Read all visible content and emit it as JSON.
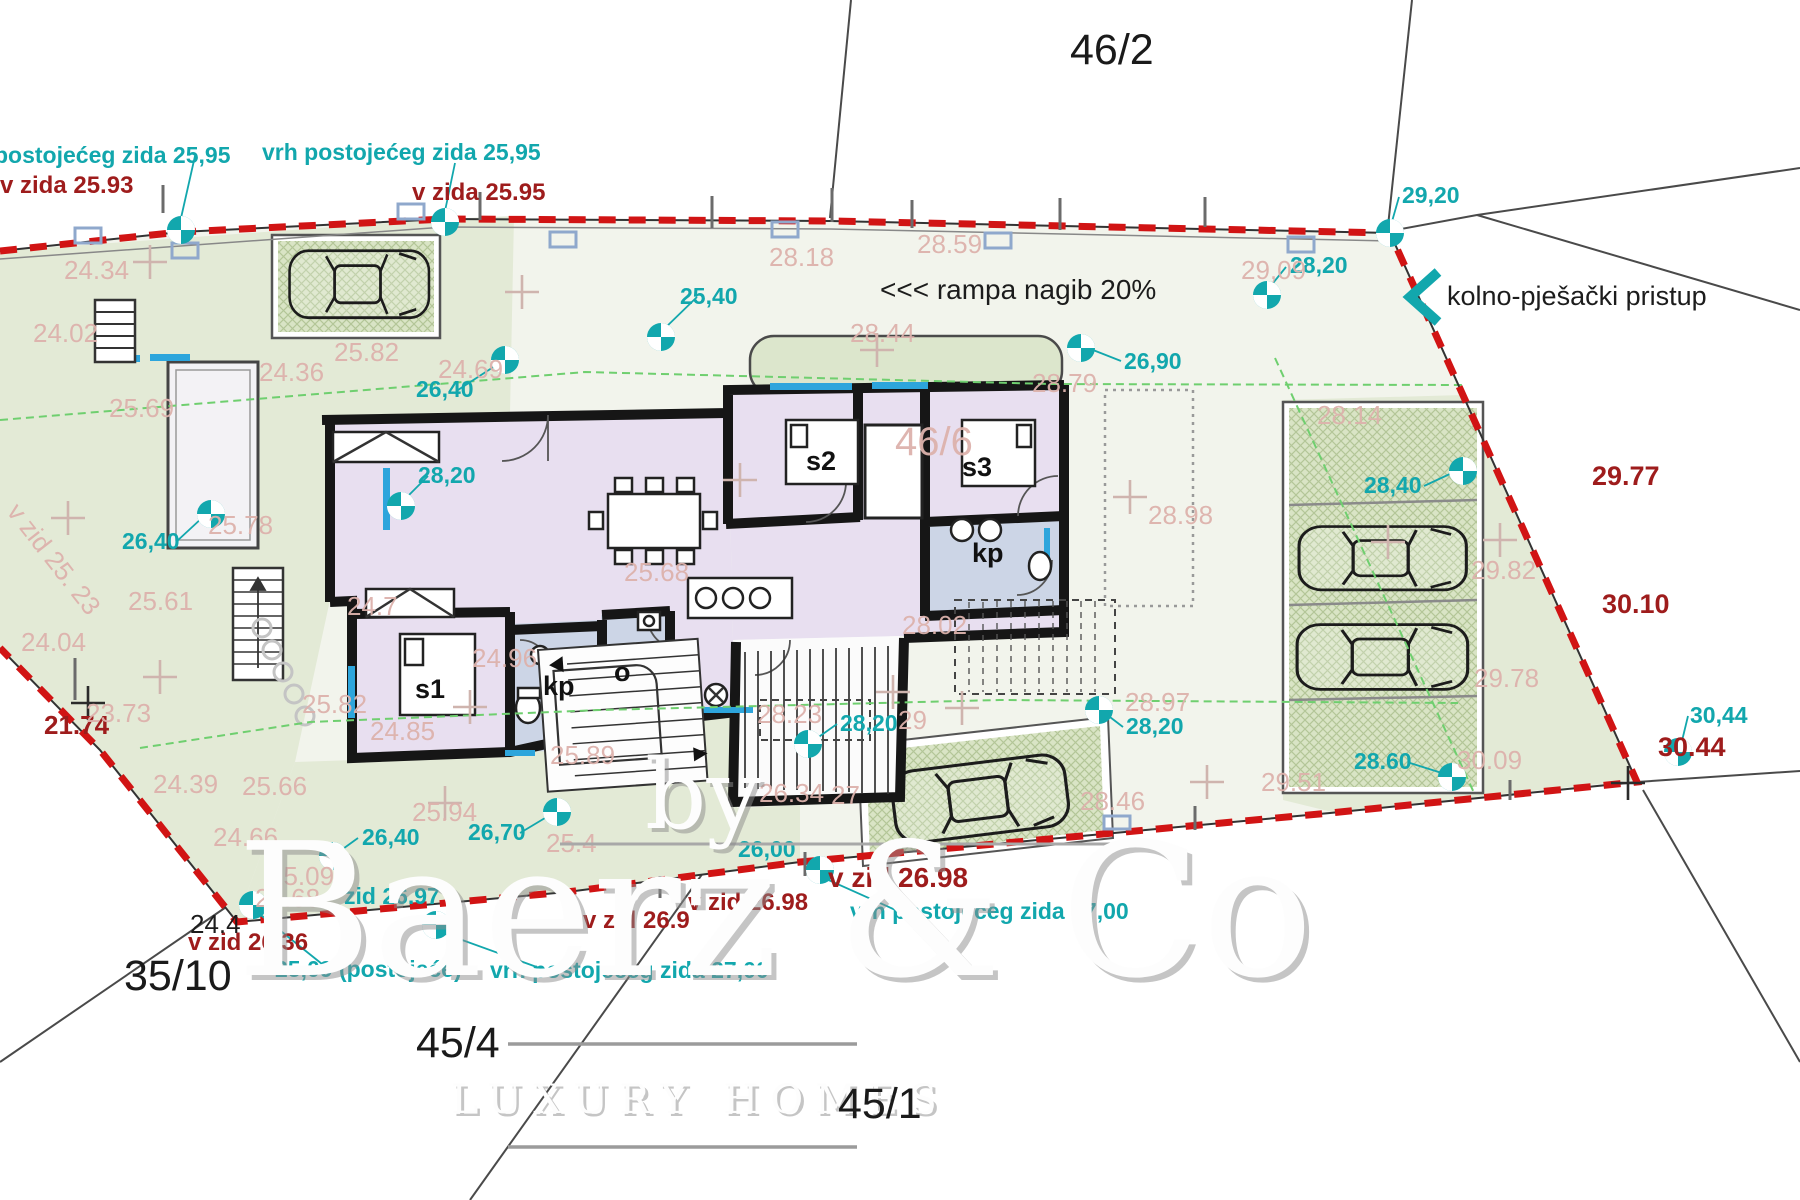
{
  "watermark": {
    "by": "by",
    "name": "Baerz & Co",
    "tagline": "LUXURY HOMES"
  },
  "annotations": {
    "ramp": "<<< rampa nagib 20%",
    "access": "kolno-pješački pristup"
  },
  "parcel_numbers": {
    "p46_2": "46/2",
    "p45_4": "45/4",
    "p35_10": "35/10",
    "p45_1": "45/1",
    "p46_6": "46/6"
  },
  "colors": {
    "survey_teal": "#12a7ad",
    "wall_red": "#9e1c1c",
    "spot_pink": "#ddb2ac",
    "boundary_red": "#d11414",
    "window_blue": "#2da5dc",
    "garden_green": "#e3ead6",
    "room_lavender": "#e8dff0",
    "bath_blue": "#ccd5e6"
  },
  "labels": {
    "teal": [
      {
        "t": "postojećeg zida 25,95",
        "x": -6,
        "y": 163
      },
      {
        "t": "vrh postojećeg zida 25,95",
        "x": 262,
        "y": 160
      },
      {
        "t": "25,40",
        "x": 680,
        "y": 304
      },
      {
        "t": "26,90",
        "x": 1124,
        "y": 369
      },
      {
        "t": "29,20",
        "x": 1402,
        "y": 203
      },
      {
        "t": "28,20",
        "x": 1290,
        "y": 273
      },
      {
        "t": "28,40",
        "x": 1364,
        "y": 493
      },
      {
        "t": "26,40",
        "x": 416,
        "y": 397
      },
      {
        "t": "28,20",
        "x": 418,
        "y": 483
      },
      {
        "t": "26,40",
        "x": 122,
        "y": 549
      },
      {
        "t": "26,40",
        "x": 362,
        "y": 845
      },
      {
        "t": "26,70",
        "x": 468,
        "y": 840
      },
      {
        "t": "zid 26.97",
        "x": 344,
        "y": 904
      },
      {
        "t": "25,09 (postojeće)",
        "x": 275,
        "y": 977
      },
      {
        "t": "vrh postojećeg zida 27,00",
        "x": 490,
        "y": 978
      },
      {
        "t": "vrh postojećeg zida 27,00",
        "x": 850,
        "y": 919
      },
      {
        "t": "26,00",
        "x": 738,
        "y": 857
      },
      {
        "t": "28,20",
        "x": 840,
        "y": 731
      },
      {
        "t": "28,20",
        "x": 1126,
        "y": 734
      },
      {
        "t": "28.60",
        "x": 1354,
        "y": 769
      },
      {
        "t": "30,44",
        "x": 1690,
        "y": 723
      }
    ],
    "red": [
      {
        "t": "v zida 25.93",
        "x": 0,
        "y": 193
      },
      {
        "t": "v zida 25.95",
        "x": 412,
        "y": 200
      },
      {
        "t": "29.77",
        "x": 1592,
        "y": 485,
        "s": 27
      },
      {
        "t": "30.10",
        "x": 1602,
        "y": 613,
        "s": 27
      },
      {
        "t": "30.44",
        "x": 1658,
        "y": 756,
        "s": 27
      },
      {
        "t": "21.74",
        "x": 44,
        "y": 734,
        "s": 26
      },
      {
        "t": "v zid 26.36",
        "x": 188,
        "y": 950
      },
      {
        "t": "v zid 26.9",
        "x": 583,
        "y": 928
      },
      {
        "t": "v zid 26.98",
        "x": 688,
        "y": 910
      },
      {
        "t": "v zid 26.98",
        "x": 828,
        "y": 887,
        "s": 28
      }
    ],
    "black": [
      {
        "t": "<<< rampa nagib 20%",
        "x": 880,
        "y": 299,
        "s": 28
      },
      {
        "t": "kolno-pješački pristup",
        "x": 1447,
        "y": 305,
        "s": 27
      },
      {
        "t": "24.4",
        "x": 190,
        "y": 933,
        "s": 26
      }
    ],
    "rooms": [
      {
        "t": "s1",
        "x": 415,
        "y": 698
      },
      {
        "t": "s2",
        "x": 806,
        "y": 470
      },
      {
        "t": "s3",
        "x": 962,
        "y": 476
      },
      {
        "t": "kp",
        "x": 543,
        "y": 695
      },
      {
        "t": "kp",
        "x": 972,
        "y": 562
      },
      {
        "t": "o",
        "x": 614,
        "y": 681
      }
    ],
    "pink": [
      {
        "t": "24.34",
        "x": 64,
        "y": 279
      },
      {
        "t": "24.02",
        "x": 33,
        "y": 342
      },
      {
        "t": "24.36",
        "x": 259,
        "y": 381
      },
      {
        "t": "25.82",
        "x": 334,
        "y": 361
      },
      {
        "t": "24.69",
        "x": 438,
        "y": 378
      },
      {
        "t": "25.69",
        "x": 109,
        "y": 417
      },
      {
        "t": "28.18",
        "x": 769,
        "y": 266
      },
      {
        "t": "28.59",
        "x": 917,
        "y": 253
      },
      {
        "t": "28.44",
        "x": 850,
        "y": 342
      },
      {
        "t": "28.79",
        "x": 1032,
        "y": 392
      },
      {
        "t": "46/6",
        "x": 895,
        "y": 455,
        "s": 40
      },
      {
        "t": "28.98",
        "x": 1148,
        "y": 524
      },
      {
        "t": "25.68",
        "x": 624,
        "y": 581
      },
      {
        "t": "25.78",
        "x": 208,
        "y": 534
      },
      {
        "t": "25.61",
        "x": 128,
        "y": 610
      },
      {
        "t": "24.04",
        "x": 21,
        "y": 651
      },
      {
        "t": "23.73",
        "x": 86,
        "y": 722
      },
      {
        "t": "24.39",
        "x": 153,
        "y": 793
      },
      {
        "t": "25.66",
        "x": 242,
        "y": 795
      },
      {
        "t": "24.66",
        "x": 213,
        "y": 846
      },
      {
        "t": "25.09",
        "x": 269,
        "y": 885
      },
      {
        "t": "24.68",
        "x": 255,
        "y": 907
      },
      {
        "t": "25.94",
        "x": 412,
        "y": 821
      },
      {
        "t": "25.4",
        "x": 546,
        "y": 852
      },
      {
        "t": "25.89",
        "x": 550,
        "y": 764
      },
      {
        "t": "25.82",
        "x": 302,
        "y": 713
      },
      {
        "t": "24.7",
        "x": 347,
        "y": 615
      },
      {
        "t": "24.96",
        "x": 472,
        "y": 667
      },
      {
        "t": "24.85",
        "x": 370,
        "y": 740
      },
      {
        "t": "28.23",
        "x": 757,
        "y": 723
      },
      {
        "t": "29",
        "x": 898,
        "y": 729
      },
      {
        "t": "26.34",
        "x": 759,
        "y": 802
      },
      {
        "t": "27",
        "x": 831,
        "y": 804
      },
      {
        "t": "28.02",
        "x": 902,
        "y": 634
      },
      {
        "t": "28.97",
        "x": 1125,
        "y": 711
      },
      {
        "t": "28.46",
        "x": 1080,
        "y": 810
      },
      {
        "t": "29.51",
        "x": 1261,
        "y": 791
      },
      {
        "t": "29.82",
        "x": 1471,
        "y": 579
      },
      {
        "t": "29.78",
        "x": 1474,
        "y": 687
      },
      {
        "t": "30.09",
        "x": 1457,
        "y": 769
      },
      {
        "t": "29,09",
        "x": 1241,
        "y": 279
      },
      {
        "t": "28.14",
        "x": 1317,
        "y": 424
      },
      {
        "t": "v zid 25. 23",
        "x": 6,
        "y": 512,
        "r": 52
      }
    ]
  },
  "markers": [
    {
      "x": 181,
      "y": 230
    },
    {
      "x": 445,
      "y": 222
    },
    {
      "x": 661,
      "y": 337
    },
    {
      "x": 1081,
      "y": 348
    },
    {
      "x": 1390,
      "y": 233
    },
    {
      "x": 1267,
      "y": 295
    },
    {
      "x": 505,
      "y": 360
    },
    {
      "x": 401,
      "y": 506
    },
    {
      "x": 211,
      "y": 514
    },
    {
      "x": 1463,
      "y": 471
    },
    {
      "x": 333,
      "y": 856
    },
    {
      "x": 557,
      "y": 812
    },
    {
      "x": 253,
      "y": 905
    },
    {
      "x": 436,
      "y": 925
    },
    {
      "x": 820,
      "y": 870
    },
    {
      "x": 808,
      "y": 744
    },
    {
      "x": 1099,
      "y": 710
    },
    {
      "x": 1452,
      "y": 777
    },
    {
      "x": 1678,
      "y": 752
    }
  ]
}
